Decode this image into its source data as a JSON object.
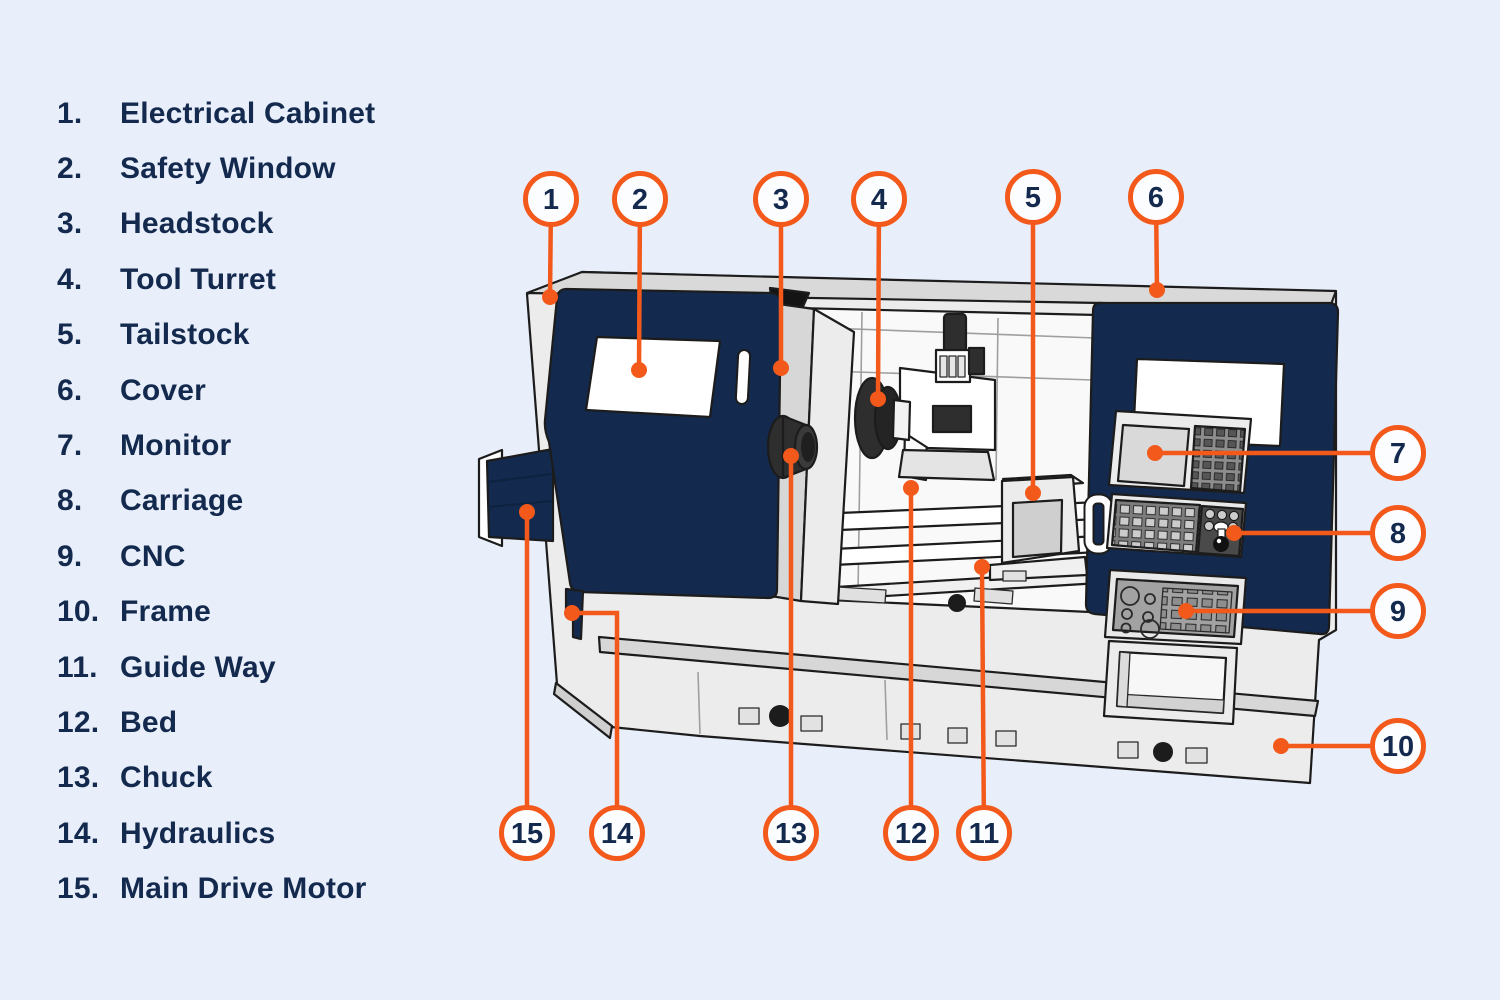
{
  "palette": {
    "background": "#e8eefa",
    "accent_orange": "#f3591b",
    "navy": "#132a4e",
    "text_navy": "#13294d",
    "machine_light": "#ececec",
    "machine_mid": "#d7d7d7",
    "machine_dark": "#2e2e2e"
  },
  "legend": {
    "items": [
      {
        "number": "1.",
        "label": "Electrical Cabinet"
      },
      {
        "number": "2.",
        "label": "Safety Window"
      },
      {
        "number": "3.",
        "label": "Headstock"
      },
      {
        "number": "4.",
        "label": "Tool Turret"
      },
      {
        "number": "5.",
        "label": "Tailstock"
      },
      {
        "number": "6.",
        "label": "Cover"
      },
      {
        "number": "7.",
        "label": "Monitor"
      },
      {
        "number": "8.",
        "label": "Carriage"
      },
      {
        "number": "9.",
        "label": "CNC"
      },
      {
        "number": "10.",
        "label": "Frame"
      },
      {
        "number": "11.",
        "label": "Guide Way"
      },
      {
        "number": "12.",
        "label": "Bed"
      },
      {
        "number": "13.",
        "label": "Chuck"
      },
      {
        "number": "14.",
        "label": "Hydraulics"
      },
      {
        "number": "15.",
        "label": "Main Drive Motor"
      }
    ]
  },
  "callouts": [
    {
      "number": "1",
      "label": "Electrical Cabinet",
      "circle": {
        "x": 551,
        "y": 199
      },
      "target": {
        "x": 550,
        "y": 297
      }
    },
    {
      "number": "2",
      "label": "Safety Window",
      "circle": {
        "x": 640,
        "y": 199
      },
      "target": {
        "x": 639,
        "y": 370
      }
    },
    {
      "number": "3",
      "label": "Headstock",
      "circle": {
        "x": 781,
        "y": 199
      },
      "target": {
        "x": 781,
        "y": 368
      }
    },
    {
      "number": "4",
      "label": "Tool Turret",
      "circle": {
        "x": 879,
        "y": 199
      },
      "target": {
        "x": 878,
        "y": 399
      }
    },
    {
      "number": "5",
      "label": "Tailstock",
      "circle": {
        "x": 1033,
        "y": 197
      },
      "target": {
        "x": 1033,
        "y": 493
      }
    },
    {
      "number": "6",
      "label": "Cover",
      "circle": {
        "x": 1156,
        "y": 197
      },
      "target": {
        "x": 1157,
        "y": 290
      }
    },
    {
      "number": "7",
      "label": "Monitor",
      "circle": {
        "x": 1398,
        "y": 453
      },
      "target": {
        "x": 1155,
        "y": 453
      }
    },
    {
      "number": "8",
      "label": "Carriage",
      "circle": {
        "x": 1398,
        "y": 533
      },
      "target": {
        "x": 1234,
        "y": 533
      }
    },
    {
      "number": "9",
      "label": "CNC",
      "circle": {
        "x": 1398,
        "y": 611
      },
      "target": {
        "x": 1186,
        "y": 611
      }
    },
    {
      "number": "10",
      "label": "Frame",
      "circle": {
        "x": 1398,
        "y": 746
      },
      "target": {
        "x": 1281,
        "y": 746
      }
    },
    {
      "number": "11",
      "label": "Guide Way",
      "circle": {
        "x": 984,
        "y": 833
      },
      "target": {
        "x": 982,
        "y": 567
      }
    },
    {
      "number": "12",
      "label": "Bed",
      "circle": {
        "x": 911,
        "y": 833
      },
      "target": {
        "x": 911,
        "y": 488
      }
    },
    {
      "number": "13",
      "label": "Chuck",
      "circle": {
        "x": 791,
        "y": 833
      },
      "target": {
        "x": 791,
        "y": 456
      }
    },
    {
      "number": "14",
      "label": "Hydraulics",
      "circle": {
        "x": 617,
        "y": 833
      },
      "elbow": {
        "x": 617,
        "y": 613
      },
      "target": {
        "x": 572,
        "y": 613
      }
    },
    {
      "number": "15",
      "label": "Main Drive Motor",
      "circle": {
        "x": 527,
        "y": 833
      },
      "target": {
        "x": 527,
        "y": 512
      }
    }
  ]
}
